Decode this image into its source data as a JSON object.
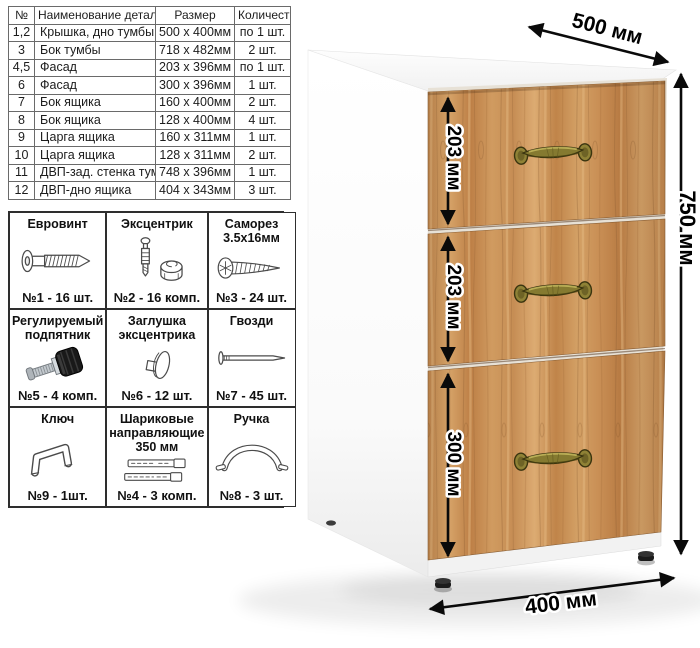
{
  "parts_table": {
    "headers": [
      "№",
      "Наименование детали",
      "Размер",
      "Количество"
    ],
    "rows": [
      [
        "1,2",
        "Крышка, дно тумбы",
        "500 x 400мм",
        "по 1 шт."
      ],
      [
        "3",
        "Бок тумбы",
        "718 x 482мм",
        "2 шт."
      ],
      [
        "4,5",
        "Фасад",
        "203 x 396мм",
        "по 1 шт."
      ],
      [
        "6",
        "Фасад",
        "300 x 396мм",
        "1 шт."
      ],
      [
        "7",
        "Бок ящика",
        "160 x 400мм",
        "2 шт."
      ],
      [
        "8",
        "Бок ящика",
        "128 x 400мм",
        "4 шт."
      ],
      [
        "9",
        "Царга ящика",
        "160 x 311мм",
        "1 шт."
      ],
      [
        "10",
        "Царга ящика",
        "128 x 311мм",
        "2 шт."
      ],
      [
        "11",
        "ДВП-зад. стенка тумбы",
        "748 x 396мм",
        "1 шт."
      ],
      [
        "12",
        "ДВП-дно ящика",
        "404 x 343мм",
        "3 шт."
      ]
    ]
  },
  "hardware_grid": {
    "cells": [
      {
        "label": "Евровинт",
        "qty": "№1 - 16 шт.",
        "icon": "euro-screw-icon"
      },
      {
        "label": "Эксцентрик",
        "qty": "№2 - 16 комп.",
        "icon": "cam-lock-icon"
      },
      {
        "label": "Саморез 3.5х16мм",
        "qty": "№3 - 24 шт.",
        "icon": "self-tapping-screw-icon"
      },
      {
        "label": "Регулируемый подпятник",
        "qty": "№5 - 4 комп.",
        "icon": "adjustable-foot-icon"
      },
      {
        "label": "Заглушка эксцентрика",
        "qty": "№6 - 12 шт.",
        "icon": "cam-cover-icon"
      },
      {
        "label": "Гвозди",
        "qty": "№7 - 45 шт.",
        "icon": "nail-icon"
      },
      {
        "label": "Ключ",
        "qty": "№9 - 1шт.",
        "icon": "hex-key-icon"
      },
      {
        "label": "Шариковые направляющие 350 мм",
        "qty": "№4 - 3 комп.",
        "icon": "drawer-slides-icon"
      },
      {
        "label": "Ручка",
        "qty": "№8 - 3 шт.",
        "icon": "handle-icon"
      }
    ]
  },
  "cabinet": {
    "dim_depth": "500 мм",
    "dim_height": "750 мм",
    "dim_width": "400 мм",
    "dim_drawer_top": "203 мм",
    "dim_drawer_middle": "203 мм",
    "dim_drawer_bottom": "300 мм",
    "colors": {
      "wood": "#c98e55",
      "handle_brass": "#857a30",
      "body": "#ffffff",
      "dimension": "#000000"
    }
  }
}
